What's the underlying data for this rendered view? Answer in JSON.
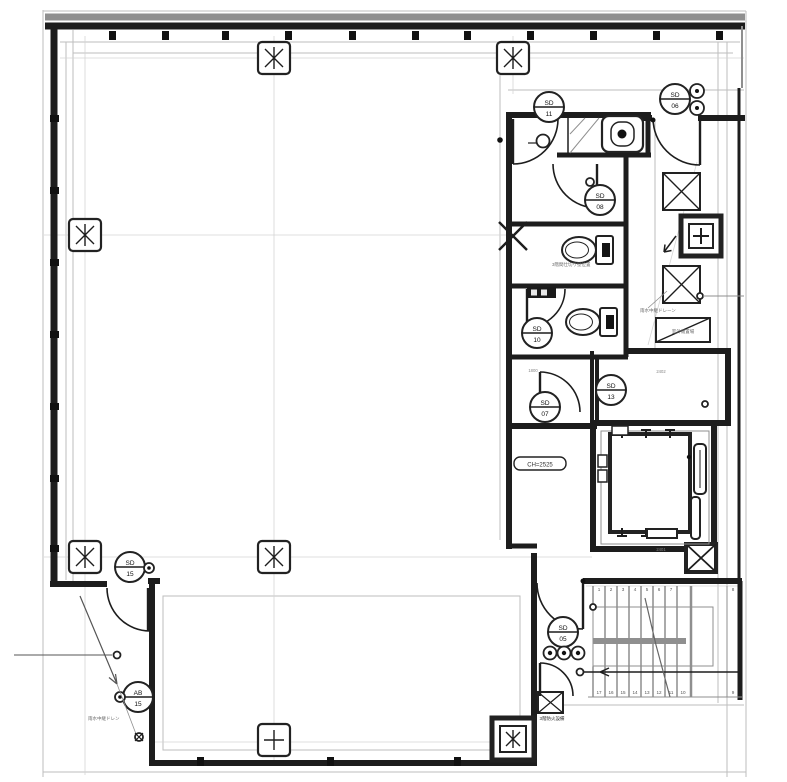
{
  "drawing": {
    "type": "architectural-floor-plan",
    "devices": {
      "sd11": {
        "code": "SD",
        "num": "11"
      },
      "sd06": {
        "code": "SD",
        "num": "06"
      },
      "sd08": {
        "code": "SD",
        "num": "08"
      },
      "sd10": {
        "code": "SD",
        "num": "10"
      },
      "sd13": {
        "code": "SD",
        "num": "13"
      },
      "sd07": {
        "code": "SD",
        "num": "07"
      },
      "sd05": {
        "code": "SD",
        "num": "05"
      },
      "sd15": {
        "code": "SD",
        "num": "15"
      },
      "ab15": {
        "code": "AB",
        "num": "15"
      }
    },
    "labels": {
      "ceiling_height": "CH=2525",
      "rain_drain_right": "雨水中継ドレーン",
      "rain_drain_left": "雨水中継ドレン",
      "partition_note": "3階間仕切り壁位置",
      "fire_note": "3階防火設備",
      "outdoor_unit": "室外機置場"
    },
    "dims": {
      "a": "2402",
      "b": "2401",
      "c": "1800"
    },
    "stairs": {
      "top": [
        "1",
        "2",
        "3",
        "4",
        "5",
        "6",
        "7",
        "8"
      ],
      "bottom": [
        "17",
        "16",
        "15",
        "14",
        "13",
        "12",
        "11",
        "10",
        "9"
      ]
    },
    "colors": {
      "wall": "#1d1d1d",
      "grid": "#bdbdbd",
      "mid": "#8f8f8f"
    }
  }
}
